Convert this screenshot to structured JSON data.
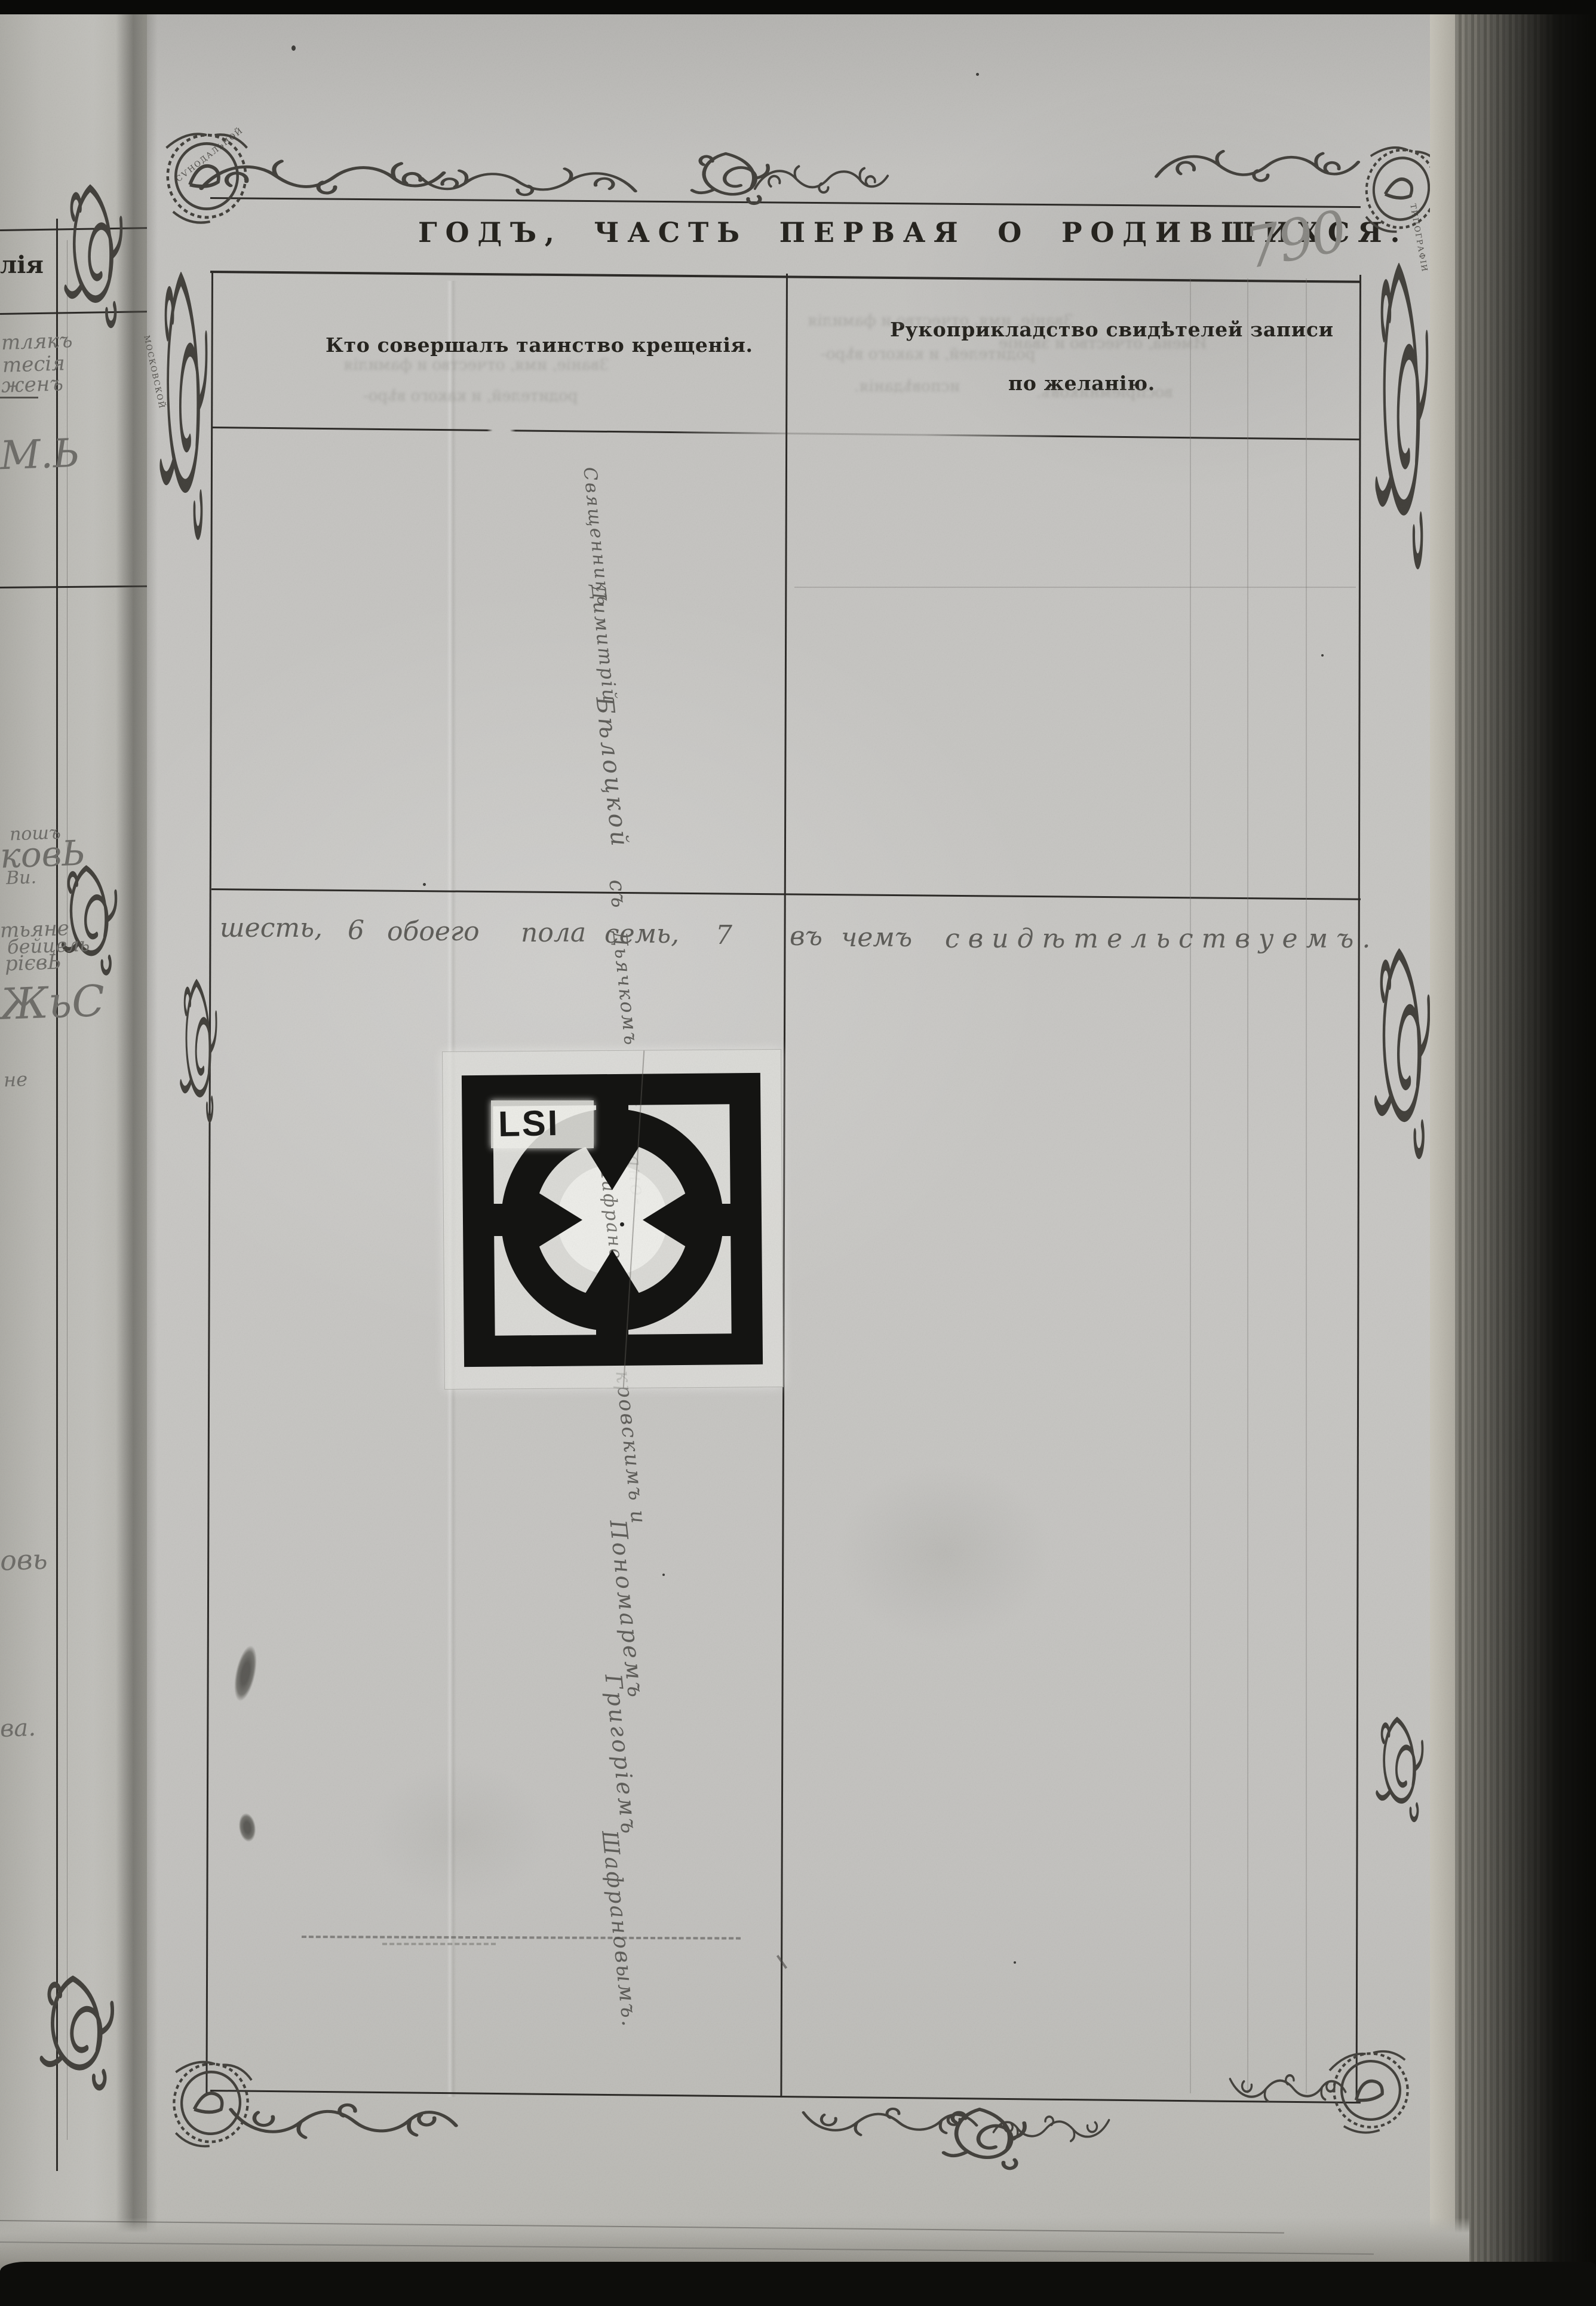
{
  "page_header": {
    "title": "ГОДЪ, ЧАСТЬ ПЕРВАЯ О РОДИВШИХСЯ.",
    "page_number": "790"
  },
  "table": {
    "col1_header": "Кто совершалъ таинство крещенія.",
    "col2_header_line1": "Рукоприкладство свидѣтелей записи",
    "col2_header_line2": "по желанію."
  },
  "handwriting": {
    "summary_tokens": [
      "шесть,",
      "6",
      "обоего",
      "пола",
      "семь,",
      "7",
      "въ",
      "чемъ",
      "свидѣтельствуемъ."
    ],
    "signature_segments": [
      "Священникъ",
      "Димитрій",
      "Бѣлоцкой",
      "съ",
      "Дьячкомъ",
      "Шафрано-",
      "кровскимъ и",
      "Пономаремъ",
      "Григоріемъ",
      "Шафрановымъ."
    ]
  },
  "facing_page": {
    "printed_fragment": "лія",
    "script_fragments": [
      "тлякъ",
      "тесія",
      "женъ",
      "М.Ь",
      "пошъ",
      "ковЬ",
      "Ви.",
      "тьяне",
      "бейцель",
      "рієвЬ",
      "ЖьС",
      "не",
      "овь",
      "ва."
    ]
  },
  "lsi_target": {
    "label": "LSI"
  },
  "ornament_ribbon": {
    "word1": "МОСКОВСКОЙ",
    "word2": "СѴНОДАЛЬНОЙ",
    "word3": "ТИПОГРАФІИ"
  },
  "ghost_bleedthrough": {
    "line1": "Званіе, имя, отчество и фамилія",
    "line2": "родителей, и какого вѣро-",
    "line3": "исповѣданія.",
    "line4": "Имена, отчество и званіе",
    "line5": "воспріемниковъ."
  },
  "colors": {
    "paper": "#c5c4c1",
    "ink_print": "#26241f",
    "ink_hand": "#5f5e5a",
    "pencil": "#8a8985",
    "plate_black": "#141412"
  }
}
